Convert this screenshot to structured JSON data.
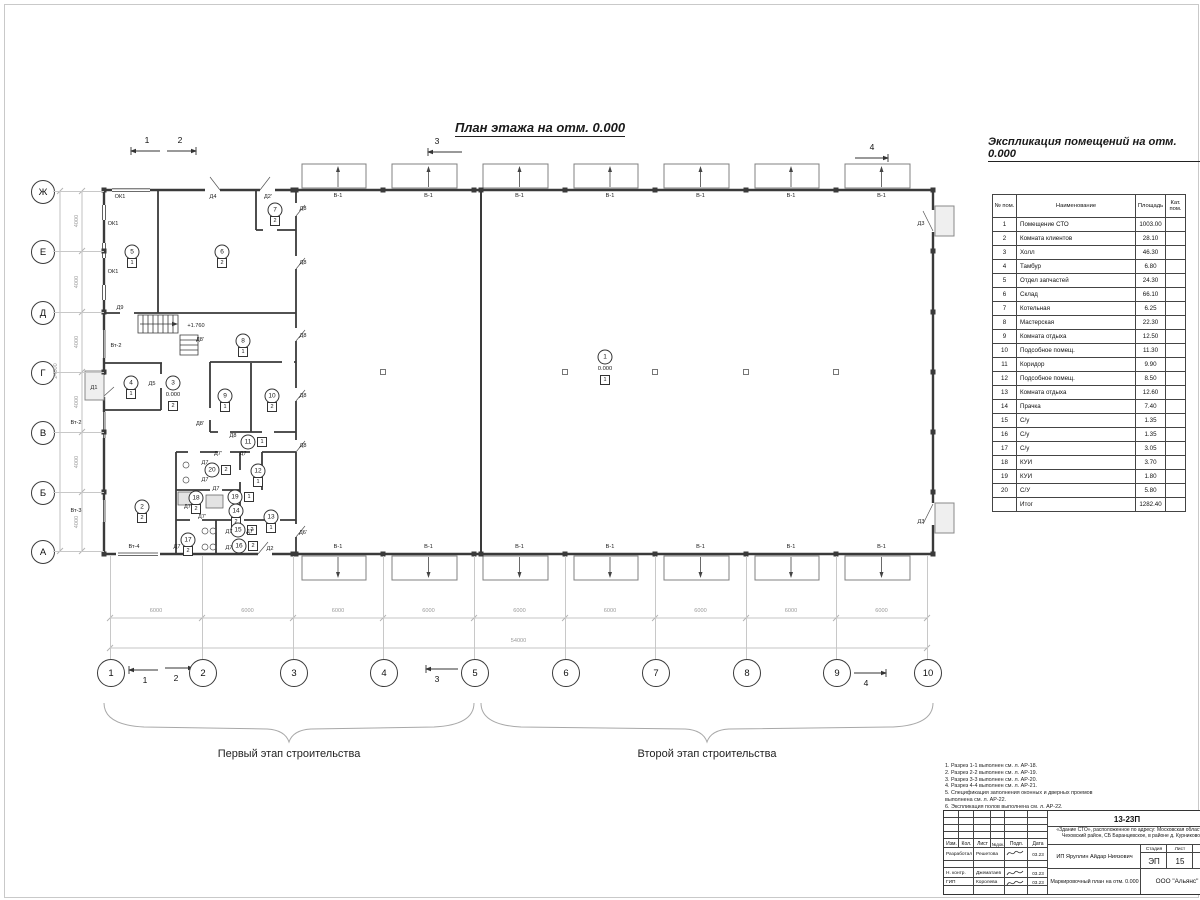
{
  "plan_title": "План этажа на отм. 0.000",
  "explication": {
    "title": "Экспликация помещений на отм. 0.000",
    "headers": {
      "num": "№ пом.",
      "name": "Наименование",
      "area": "Площадь",
      "cat": "Кат. пом."
    },
    "rows": [
      [
        "1",
        "Помещение СТО",
        "1003.00"
      ],
      [
        "2",
        "Комната клиентов",
        "28.10"
      ],
      [
        "3",
        "Холл",
        "46.30"
      ],
      [
        "4",
        "Тамбур",
        "6.80"
      ],
      [
        "5",
        "Отдел запчастей",
        "24.30"
      ],
      [
        "6",
        "Склад",
        "66.10"
      ],
      [
        "7",
        "Котельная",
        "6.25"
      ],
      [
        "8",
        "Мастерская",
        "22.30"
      ],
      [
        "9",
        "Комната отдыха",
        "12.50"
      ],
      [
        "10",
        "Подсобное помещ.",
        "11.30"
      ],
      [
        "11",
        "Коридор",
        "9.90"
      ],
      [
        "12",
        "Подсобное помещ.",
        "8.50"
      ],
      [
        "13",
        "Комната отдыха",
        "12.60"
      ],
      [
        "14",
        "Прачка",
        "7.40"
      ],
      [
        "15",
        "С/у",
        "1.35"
      ],
      [
        "16",
        "С/у",
        "1.35"
      ],
      [
        "17",
        "С/у",
        "3.05"
      ],
      [
        "18",
        "КУИ",
        "3.70"
      ],
      [
        "19",
        "КУИ",
        "1.80"
      ],
      [
        "20",
        "С/У",
        "5.80"
      ]
    ],
    "total_label": "Итог",
    "total_value": "1282.40"
  },
  "axes": {
    "horizontal": [
      {
        "label": "Ж",
        "y": 191
      },
      {
        "label": "Е",
        "y": 251
      },
      {
        "label": "Д",
        "y": 312
      },
      {
        "label": "Г",
        "y": 372
      },
      {
        "label": "В",
        "y": 432
      },
      {
        "label": "Б",
        "y": 492
      },
      {
        "label": "А",
        "y": 551
      }
    ],
    "vertical": [
      {
        "label": "1",
        "x": 110
      },
      {
        "label": "2",
        "x": 202
      },
      {
        "label": "3",
        "x": 293
      },
      {
        "label": "4",
        "x": 383
      },
      {
        "label": "5",
        "x": 474
      },
      {
        "label": "6",
        "x": 565
      },
      {
        "label": "7",
        "x": 655
      },
      {
        "label": "8",
        "x": 746
      },
      {
        "label": "9",
        "x": 836
      },
      {
        "label": "10",
        "x": 927
      }
    ]
  },
  "dimensions": {
    "bay": "6000",
    "total_width": "54000",
    "row": "4000",
    "total_height": "24000"
  },
  "gate_label": "В-1",
  "stage_labels": {
    "first": "Первый этап строительства",
    "second": "Второй этап строительства"
  },
  "section_marks": [
    {
      "t": "1",
      "x1": 160,
      "x2": 131,
      "y": 151,
      "dir": "left",
      "tx": 147,
      "ty": 140
    },
    {
      "t": "2",
      "x1": 167,
      "x2": 196,
      "y": 151,
      "dir": "right",
      "tx": 180,
      "ty": 140
    },
    {
      "t": "3",
      "x1": 462,
      "x2": 428,
      "y": 152,
      "dir": "left",
      "tx": 437,
      "ty": 141
    },
    {
      "t": "4",
      "x1": 855,
      "x2": 888,
      "y": 158,
      "dir": "right",
      "tx": 872,
      "ty": 147
    },
    {
      "t": "1",
      "x1": 158,
      "x2": 129,
      "y": 670,
      "dir": "left",
      "tx": 145,
      "ty": 680
    },
    {
      "t": "2",
      "x1": 165,
      "x2": 193,
      "y": 668,
      "dir": "right",
      "tx": 176,
      "ty": 678
    },
    {
      "t": "3",
      "x1": 458,
      "x2": 426,
      "y": 669,
      "dir": "left",
      "tx": 437,
      "ty": 679
    },
    {
      "t": "4",
      "x1": 854,
      "x2": 886,
      "y": 673,
      "dir": "right",
      "tx": 866,
      "ty": 683
    }
  ],
  "rooms": [
    {
      "n": "1",
      "x": 605,
      "y": 357,
      "level": "0.000",
      "f": "1",
      "fp": "b"
    },
    {
      "n": "2",
      "x": 142,
      "y": 507,
      "f": "2",
      "fp": "b"
    },
    {
      "n": "3",
      "x": 173,
      "y": 383,
      "level": "0.000",
      "f": "2",
      "fp": "b"
    },
    {
      "n": "4",
      "x": 131,
      "y": 383,
      "f": "1",
      "fp": "b"
    },
    {
      "n": "5",
      "x": 132,
      "y": 252,
      "f": "1",
      "fp": "b"
    },
    {
      "n": "6",
      "x": 222,
      "y": 252,
      "f": "2",
      "fp": "b"
    },
    {
      "n": "7",
      "x": 275,
      "y": 210,
      "f": "2",
      "fp": "b"
    },
    {
      "n": "8",
      "x": 243,
      "y": 341,
      "f": "1",
      "fp": "b"
    },
    {
      "n": "9",
      "x": 225,
      "y": 396,
      "f": "1",
      "fp": "b"
    },
    {
      "n": "10",
      "x": 272,
      "y": 396,
      "f": "2",
      "fp": "b"
    },
    {
      "n": "11",
      "x": 248,
      "y": 442,
      "f": "1",
      "fp": "r"
    },
    {
      "n": "12",
      "x": 258,
      "y": 471,
      "f": "1",
      "fp": "b"
    },
    {
      "n": "13",
      "x": 271,
      "y": 517,
      "f": "1",
      "fp": "b"
    },
    {
      "n": "14",
      "x": 236,
      "y": 511,
      "f": "2",
      "fp": "b"
    },
    {
      "n": "15",
      "x": 238,
      "y": 530,
      "f": "2",
      "fp": "r"
    },
    {
      "n": "16",
      "x": 239,
      "y": 546,
      "f": "2",
      "fp": "r"
    },
    {
      "n": "17",
      "x": 188,
      "y": 540,
      "f": "2",
      "fp": "b"
    },
    {
      "n": "18",
      "x": 196,
      "y": 498,
      "f": "2",
      "fp": "b"
    },
    {
      "n": "19",
      "x": 235,
      "y": 497,
      "f": "1",
      "fp": "r"
    },
    {
      "n": "20",
      "x": 212,
      "y": 470,
      "f": "2",
      "fp": "r"
    }
  ],
  "plan_labels": [
    {
      "t": "Д4",
      "x": 213,
      "y": 197
    },
    {
      "t": "Д2'",
      "x": 268,
      "y": 197
    },
    {
      "t": "Д8",
      "x": 303,
      "y": 209
    },
    {
      "t": "Д8",
      "x": 303,
      "y": 263
    },
    {
      "t": "Д8",
      "x": 303,
      "y": 336
    },
    {
      "t": "Д8",
      "x": 303,
      "y": 396
    },
    {
      "t": "Д8",
      "x": 303,
      "y": 446
    },
    {
      "t": "Д6'",
      "x": 303,
      "y": 533
    },
    {
      "t": "Д3",
      "x": 921,
      "y": 224
    },
    {
      "t": "Д3",
      "x": 921,
      "y": 522
    },
    {
      "t": "Д9",
      "x": 120,
      "y": 308
    },
    {
      "t": "Д1",
      "x": 94,
      "y": 388
    },
    {
      "t": "Д5",
      "x": 152,
      "y": 384
    },
    {
      "t": "Д8'",
      "x": 200,
      "y": 340
    },
    {
      "t": "Д8'",
      "x": 200,
      "y": 424
    },
    {
      "t": "Д8",
      "x": 233,
      "y": 436
    },
    {
      "t": "Д7'",
      "x": 218,
      "y": 454
    },
    {
      "t": "Д7",
      "x": 243,
      "y": 454
    },
    {
      "t": "Д7",
      "x": 205,
      "y": 463
    },
    {
      "t": "Д7",
      "x": 205,
      "y": 480
    },
    {
      "t": "Д7",
      "x": 216,
      "y": 489
    },
    {
      "t": "Д7'",
      "x": 188,
      "y": 507
    },
    {
      "t": "Д7'",
      "x": 202,
      "y": 517
    },
    {
      "t": "Д7",
      "x": 229,
      "y": 532
    },
    {
      "t": "Д7'",
      "x": 250,
      "y": 532
    },
    {
      "t": "Д7",
      "x": 177,
      "y": 547
    },
    {
      "t": "Д7",
      "x": 229,
      "y": 548
    },
    {
      "t": "Д2",
      "x": 270,
      "y": 549
    },
    {
      "t": "ОК1",
      "x": 120,
      "y": 197
    },
    {
      "t": "ОК1",
      "x": 113,
      "y": 224
    },
    {
      "t": "ОК1",
      "x": 113,
      "y": 272
    },
    {
      "t": "Вт-2",
      "x": 116,
      "y": 346
    },
    {
      "t": "Вт-2",
      "x": 76,
      "y": 423
    },
    {
      "t": "Вт-3",
      "x": 76,
      "y": 511
    },
    {
      "t": "Вт-4",
      "x": 134,
      "y": 547
    },
    {
      "t": "+1.760",
      "x": 196,
      "y": 326
    }
  ],
  "notes": [
    "1. Разрез 1-1 выполнен см. л. АР-18.",
    "2. Разрез 2-2 выполнен см. л. АР-19.",
    "3. Разрез 3-3 выполнен см. л. АР-20.",
    "4. Разрез 4-4 выполнен см. л. АР-21.",
    "5. Спецификация заполнения оконных и дверных проемов выполнена см. л. АР-22.",
    "6. Экспликация полов выполнена см. л. АР-22."
  ],
  "titleblock": {
    "doc_number": "13-23П",
    "object": "«Здание СТО», расположенное по адресу: Московская область, Чеховский район, СБ Баранцевское, в районе д. Курниково",
    "col_izm": "Изм.",
    "col_kol": "Кол.",
    "col_list": "Лист",
    "col_ndok": "№док.",
    "col_podp": "Подп.",
    "col_data": "Дата",
    "row1_role": "Разработал",
    "row1_name": "Решетова",
    "row1_date": "03.23",
    "row2_role": "Н. контр.",
    "row2_name": "Джематаев",
    "row2_date": "03.23",
    "row3_role": "ГИП",
    "row3_name": "Королева",
    "row3_date": "03.23",
    "customer": "ИП Яруллин Айдар Ниязович",
    "sheet_title": "Маркировочный план на отм. 0.000",
    "stage_label": "Стадия",
    "list_label": "Лист",
    "stage": "ЭП",
    "list_num": "15",
    "company": "ООО \"Альянс\""
  }
}
